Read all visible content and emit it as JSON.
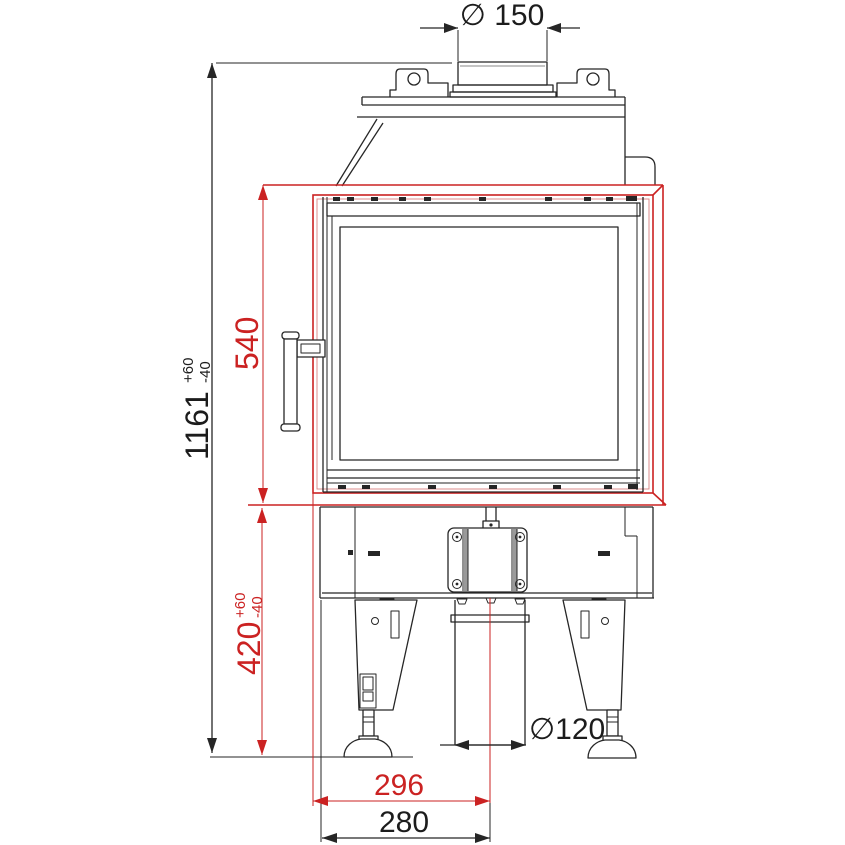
{
  "drawing": {
    "description": "fireplace-insert-front-elevation",
    "colors": {
      "accent_red": "#cb2222",
      "line_black": "#262626",
      "background": "#ffffff"
    }
  },
  "dimensions": {
    "flue_diameter": {
      "label": "∅ 150"
    },
    "total_height": {
      "value": "1161",
      "tol_plus": "+60",
      "tol_minus": "-40"
    },
    "opening_height": {
      "value": "540"
    },
    "base_height": {
      "value": "420",
      "tol_plus": "+60",
      "tol_minus": "-40"
    },
    "intake_diameter": {
      "label": "∅120"
    },
    "offset_frame_red": {
      "value": "296"
    },
    "offset_frame_black": {
      "value": "280"
    }
  }
}
